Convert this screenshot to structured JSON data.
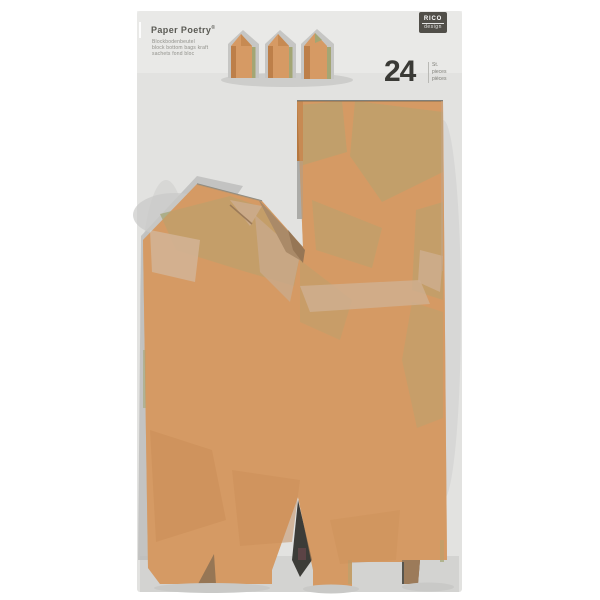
{
  "product": {
    "brand_line": "Paper Poetry",
    "brand_mark": "®",
    "sub_lines": [
      "Blockbodenbeutel",
      "block bottom bags kraft",
      "sachets fond bloc"
    ],
    "count": "24",
    "count_units": [
      "St.",
      "pieces",
      "pièces"
    ],
    "logo_top": "RICO",
    "logo_bottom": "design"
  },
  "icons": {
    "small_bags": [
      "kraft-bag-icon",
      "kraft-bag-icon",
      "kraft-bag-icon"
    ],
    "large_bag": "kraft-block-bottom-bag"
  },
  "colors": {
    "package": "#e2e2e0",
    "package_light": "#ebebe9",
    "package_shadow": "#c9c9c7",
    "kraft": "#d69a64",
    "kraft_dark": "#bd7f49",
    "olive": "#a3a674",
    "plastic_gray": "#bcbcba",
    "shadow_dark": "#4a4a44",
    "logo_bg": "#514f49"
  }
}
